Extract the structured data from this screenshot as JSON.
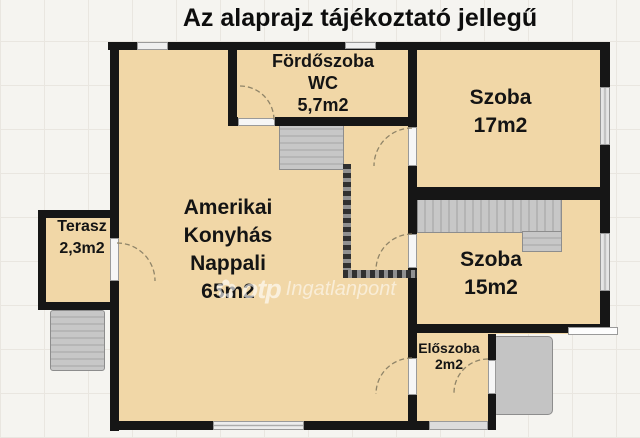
{
  "title": "Az alaprajz tájékoztató jellegű",
  "watermark": {
    "logo_icon": "otp-flower-icon",
    "brand": "otp",
    "name": "Ingatlanpont"
  },
  "colors": {
    "room_fill": "#f1d7a7",
    "wall": "#161616",
    "background": "#f5f4f0",
    "gray_feature": "#c4c4c4",
    "watermark_text": "#ffffff",
    "label_text": "#141414"
  },
  "rooms": [
    {
      "name": "Fördőszoba WC",
      "area": "5,7m2",
      "lines": [
        "Fördőszoba",
        "WC",
        "5,7m2"
      ]
    },
    {
      "name": "Szoba",
      "area": "17m2",
      "lines": [
        "Szoba",
        "17m2"
      ]
    },
    {
      "name": "Amerikai Konyhás Nappali",
      "area": "65m2",
      "lines": [
        "Amerikai",
        "Konyhás",
        "Nappali",
        "65m2"
      ]
    },
    {
      "name": "Terasz",
      "area": "2,3m2",
      "lines": [
        "Terasz",
        "2,3m2"
      ]
    },
    {
      "name": "Szoba",
      "area": "15m2",
      "lines": [
        "Szoba",
        "15m2"
      ]
    },
    {
      "name": "Előszoba",
      "area": "2m2",
      "lines": [
        "Előszoba",
        "2m2"
      ]
    }
  ]
}
